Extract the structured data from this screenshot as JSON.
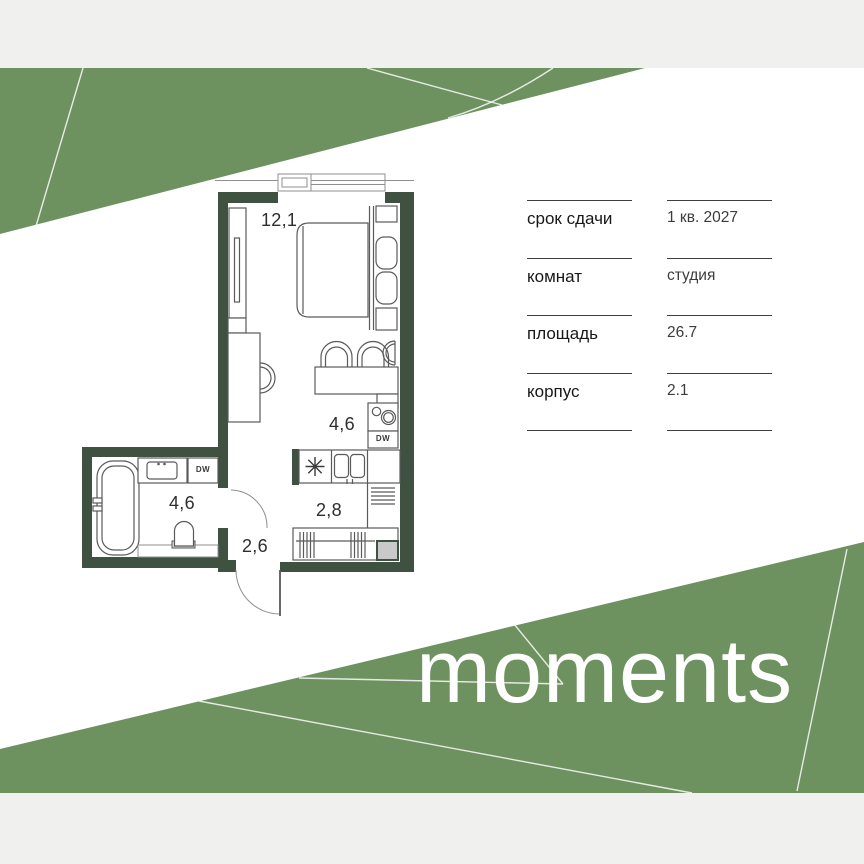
{
  "brand": {
    "logo": "moments"
  },
  "specs": {
    "rows": [
      {
        "label": "срок сдачи",
        "value": "1 кв. 2027"
      },
      {
        "label": "комнат",
        "value": "студия"
      },
      {
        "label": "площадь",
        "value": "26.7"
      },
      {
        "label": "корпус",
        "value": "2.1"
      }
    ]
  },
  "plan": {
    "labels": {
      "living": "12,1",
      "kitchen": "4,6",
      "bathroom": "4,6",
      "hallway": "2,8",
      "entry": "2,6"
    },
    "appliances": {
      "dishwasher": "DW",
      "washer": "DW"
    }
  },
  "icons": {
    "vent": "asterisk-symbol",
    "stove": "two-burner-hob",
    "sink": "double-basin-sink"
  },
  "colors": {
    "band_green": "#6e9160",
    "wall_green": "#3f5140",
    "strip_gray": "#f0f0ee",
    "shaft_gray": "#c9c9c9",
    "logo_white": "#ffffff"
  }
}
